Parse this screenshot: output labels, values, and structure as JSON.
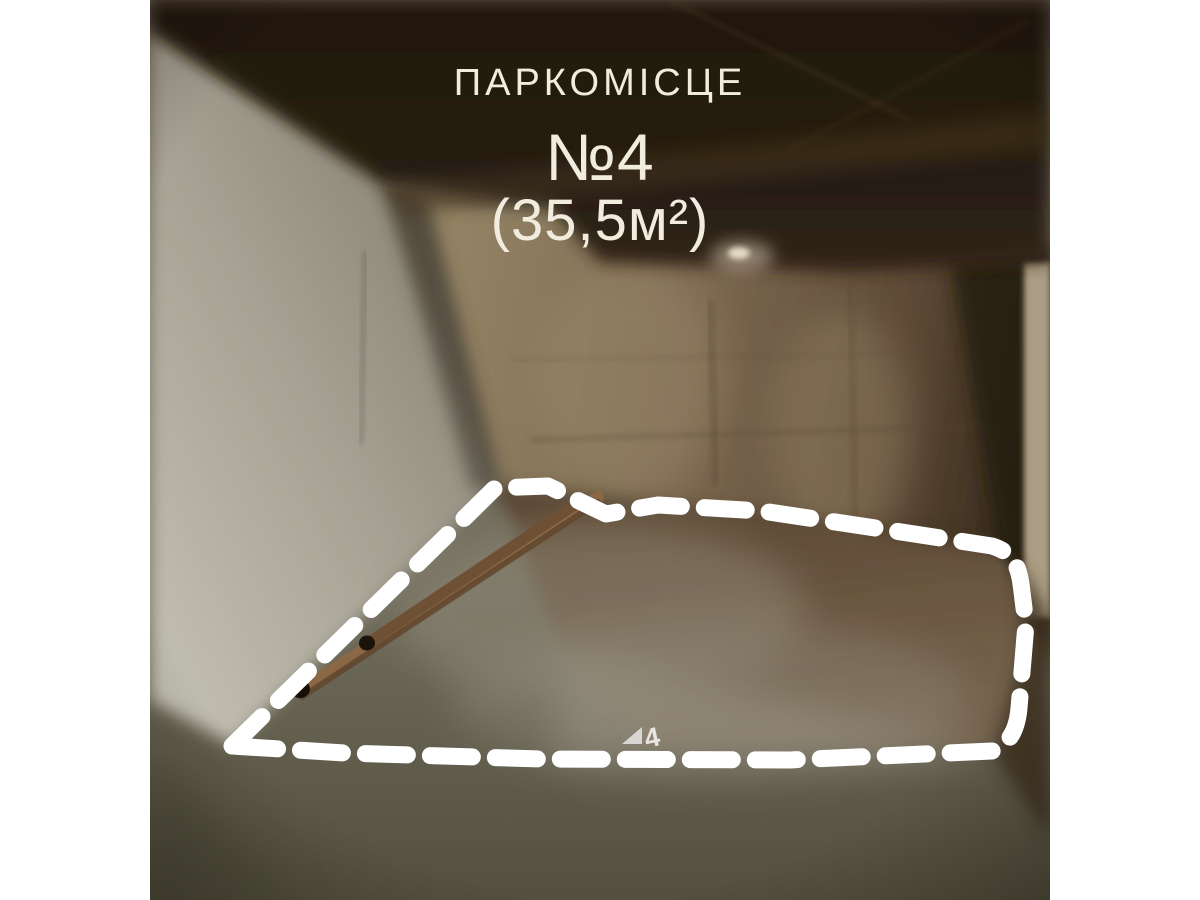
{
  "overlay": {
    "title": "ПАРКОМІСЦЕ",
    "number": "№4",
    "area": "(35,5м²)"
  },
  "floor_marking": {
    "number": "4"
  },
  "colors": {
    "page_background": "#ffffff",
    "caption_text": "#f2ecdf",
    "outline": "#ffffff",
    "ceiling": "#241b12",
    "left_wall": "#b9b5a9",
    "back_wall": "#7a6750",
    "floor": "#76715f",
    "marked_floor": "#5e4730"
  }
}
